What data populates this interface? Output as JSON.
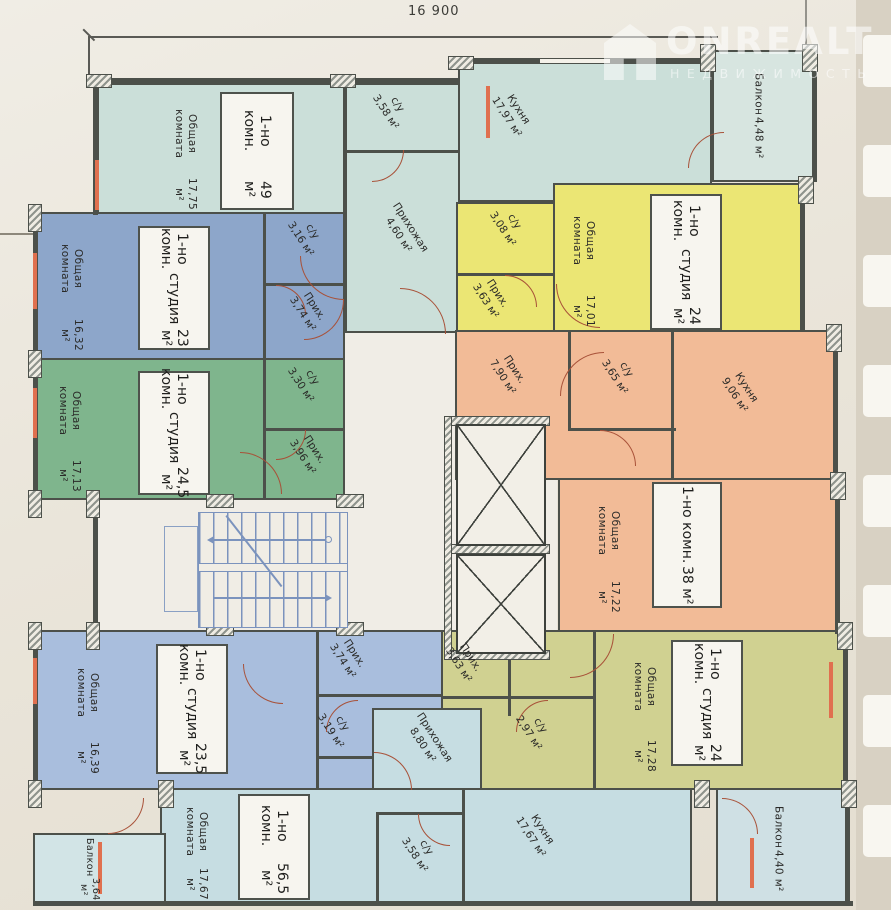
{
  "page": {
    "dimension_top": "16 900",
    "watermark": {
      "brand": "ONREALT",
      "subtitle": "НЕДВИЖИМОСТЬ"
    }
  },
  "colors": {
    "teal_unit": "#cbdfd9",
    "blue_unit": "#8da6ca",
    "green_unit": "#7fb58d",
    "yellow_unit": "#ebe674",
    "orange_unit": "#f2bb97",
    "olive_unit": "#d0d191",
    "lightblue_unit": "#a9bedd",
    "bottom_unit": "#c6dde2",
    "wall": "#4c504a",
    "door": "#a85138",
    "stairs": "#7b93bd",
    "window_mark": "#e0704f"
  },
  "units": {
    "u49": {
      "label": {
        "line1": "1-но комн.",
        "area": "49 м²"
      },
      "living": {
        "name": "Общая комната",
        "area": "17,75 м²"
      },
      "bath": {
        "name": "с/у",
        "area": "3,58 м²"
      },
      "hall": {
        "name": "Прихожая",
        "area": "4,60 м²"
      },
      "kitchen": {
        "name": "Кухня",
        "area": "17,97 м²"
      },
      "balcony": {
        "name": "Балкон",
        "area": "4,48 м²"
      }
    },
    "u23": {
      "label": {
        "line1": "1-но комн.",
        "line2": "студия",
        "area": "23 м²"
      },
      "living": {
        "name": "Общая комната",
        "area": "16,32 м²"
      },
      "bath": {
        "name": "с/у",
        "area": "3,16 м²"
      },
      "hall": {
        "name": "Прих.",
        "area": "3,74 м²"
      }
    },
    "u245": {
      "label": {
        "line1": "1-но комн.",
        "line2": "студия",
        "area": "24,5 м²"
      },
      "living": {
        "name": "Общая комната",
        "area": "17,13 м²"
      },
      "bath": {
        "name": "с/у",
        "area": "3,30 м²"
      },
      "hall": {
        "name": "Прих.",
        "area": "3,96 м²"
      }
    },
    "u24y": {
      "label": {
        "line1": "1-но комн.",
        "line2": "студия",
        "area": "24 м²"
      },
      "living": {
        "name": "Общая комната",
        "area": "17,01 м²"
      },
      "bath": {
        "name": "с/у",
        "area": "3,08 м²"
      },
      "hall": {
        "name": "Прих.",
        "area": "3,63 м²"
      }
    },
    "u38": {
      "label": {
        "line1": "1-но комн.",
        "area": "38 м²"
      },
      "living": {
        "name": "Общая комната",
        "area": "17,22 м²"
      },
      "bath": {
        "name": "с/у",
        "area": "3,65 м²"
      },
      "hall": {
        "name": "Прих.",
        "area": "7,90 м²"
      },
      "kitchen": {
        "name": "Кухня",
        "area": "9,06 м²"
      }
    },
    "u24o": {
      "label": {
        "line1": "1-но комн.",
        "line2": "студия",
        "area": "24 м²"
      },
      "living": {
        "name": "Общая комната",
        "area": "17,28 м²"
      },
      "bath": {
        "name": "с/у",
        "area": "2,97 м²"
      },
      "hall": {
        "name": "Прих.",
        "area": "3,63 м²"
      },
      "balcony": {
        "name": "Балкон",
        "area": "4,40 м²"
      }
    },
    "u235": {
      "label": {
        "line1": "1-но комн.",
        "line2": "студия",
        "area": "23,5 м²"
      },
      "living": {
        "name": "Общая комната",
        "area": "16,39 м²"
      },
      "bath": {
        "name": "с/у",
        "area": "3,19 м²"
      },
      "hall": {
        "name": "Прих.",
        "area": "3,74 м²"
      }
    },
    "u565": {
      "label": {
        "line1": "1-но комн.",
        "area": "56,5 м²"
      },
      "living": {
        "name": "Общая комната",
        "area": "17,67 м²"
      },
      "bath": {
        "name": "с/у",
        "area": "3,58 м²"
      },
      "hall": {
        "name": "Прихожая",
        "area": "8,80 м²"
      },
      "kitchen": {
        "name": "Кухня",
        "area": "17,67 м²"
      },
      "balcony": {
        "name": "Балкон",
        "area": "3,64 м²"
      }
    }
  }
}
